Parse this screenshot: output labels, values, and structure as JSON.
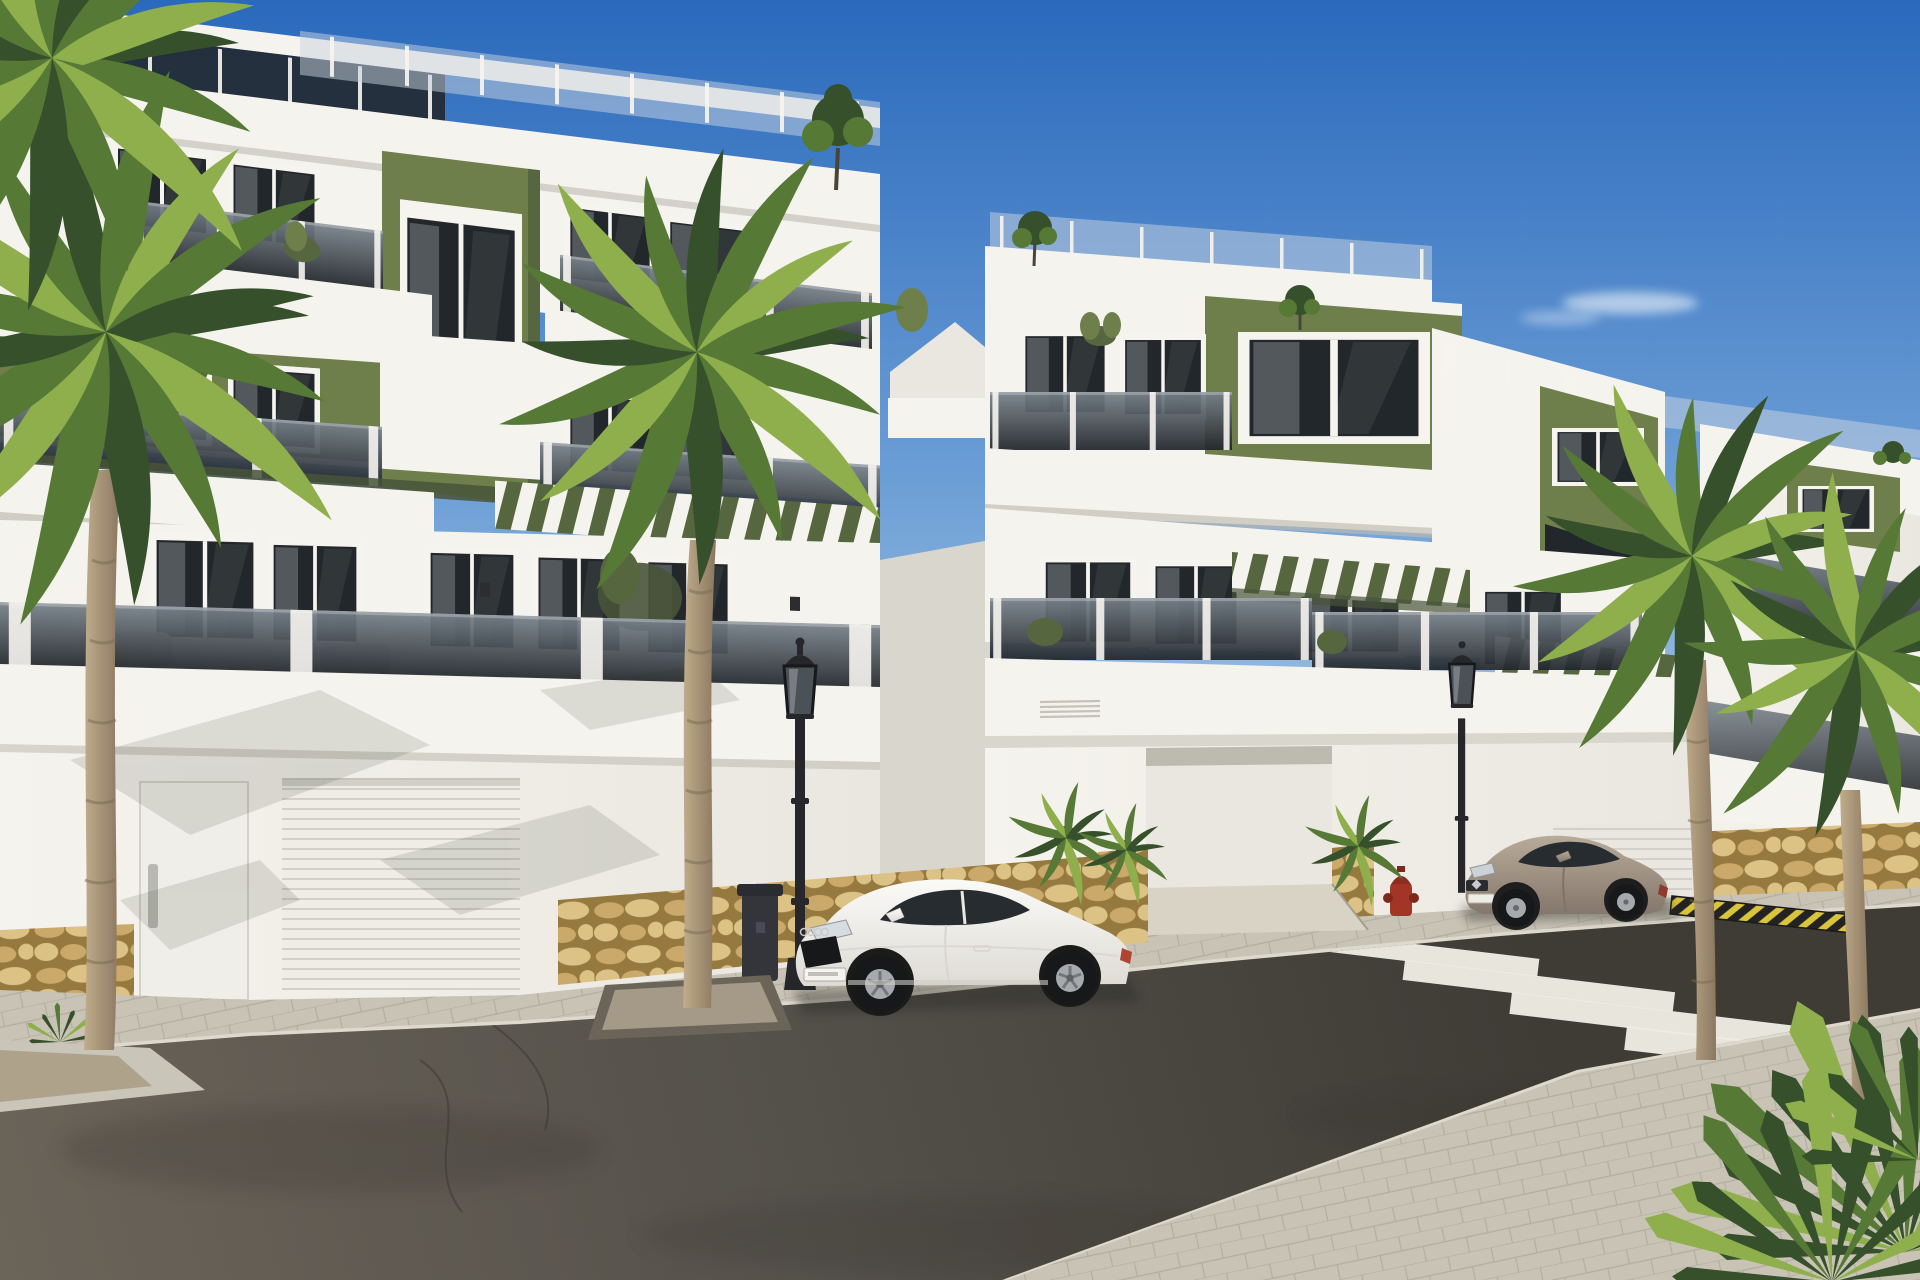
{
  "page": {
    "title": "New-build apartment complex — sunny street rendering"
  },
  "scene": {
    "type": "architectural_render",
    "description": "Sunny 3D architect's rendering of a modern terraced apartment complex: white facades with olive-green accent panels, tinted-glass balconies, rooftop terraces with glass railings and shrubs, green pergola slats, garage doors over natural-stone base walls, palm trees, a white sports coupe and a beige hatchback parked along a grey asphalt street with a zebra crosswalk, classic black street lamps, a litter bin, a red fire hydrant and a yellow-black kerb marking under a clear blue sky.",
    "time_of_day": "daytime, clear blue sky with one small cloud",
    "objects": [
      "apartment building (near block)",
      "apartment building (middle block)",
      "apartment building (stepped block)",
      "apartment building (far block)",
      "rooftop glass railing",
      "rooftop shrubs",
      "olive-green accent panels",
      "tinted glass balcony railings",
      "green pergola slats",
      "balcony plants",
      "patio furniture",
      "wall sconces",
      "vent grilles",
      "pedestrian door",
      "garage doors",
      "stone base walls",
      "paved sidewalk",
      "street planter",
      "asphalt road",
      "zebra crosswalk",
      "driveway ramp",
      "yellow-black kerb marking",
      "white coupe car",
      "beige hatchback car",
      "street lamps",
      "litter bin",
      "fire hydrant",
      "palm trees",
      "foreground palm plant",
      "small cloud"
    ],
    "counts": {
      "building_steps": 4,
      "floors_visible": 3,
      "palm_trees": 5,
      "cars": 2,
      "street_lamps": 2,
      "crosswalk_stripes": 5,
      "garage_doors": 2,
      "rooftop_shrubs": 4
    }
  },
  "colors": {
    "sky_top": "#2a69bc",
    "sky_mid": "#6d9fd6",
    "sky_low": "#bfd6ec",
    "sky_horizon": "#eaf1f8",
    "white_lit": "#f5f3ed",
    "white_mid": "#eae7e0",
    "white_shade": "#d9d6cd",
    "white_deep": "#bdbab0",
    "green_lit": "#87955e",
    "green_mid": "#6f7f4b",
    "green_dark": "#566740",
    "green_deep": "#49543a",
    "glass_top": "#77818a",
    "glass_bottom": "#20252a",
    "window_dark": "#22272b",
    "frame_white": "#f6f4ef",
    "curtain": "#8e9499",
    "walk_lit": "#c8c3b5",
    "walk_shade": "#b0ab9d",
    "curb_light": "#ddd9cc",
    "road_light": "#6b6459",
    "road_mid": "#55514b",
    "road_dark": "#3f3c36",
    "stripe_white": "#efede3",
    "stone_a": "#cba96a",
    "stone_b": "#ddc286",
    "stone_joint": "#96793f",
    "ramp_concrete": "#d8d3c5",
    "car_white_hi": "#fafaf7",
    "car_white_lo": "#dedbd4",
    "car_glass": "#272c31",
    "car_beige_hi": "#b9ab9a",
    "car_beige_lo": "#84776b",
    "tire_black": "#17181a",
    "rim_silver": "#a6aaae",
    "lamp_black": "#26262b",
    "bin_gray": "#33353a",
    "hydrant_red": "#a23526",
    "trunk_light": "#c0ad8c",
    "trunk_dark": "#8a7760",
    "palm_frond_dark": "#35502a",
    "palm_frond_mid": "#567936",
    "palm_frond_light": "#8fae4c",
    "blade_light": "#a9c755",
    "shadow_dark": "#2b2b27",
    "hazard_yellow": "#d9c53c",
    "hazard_black": "#232323"
  }
}
